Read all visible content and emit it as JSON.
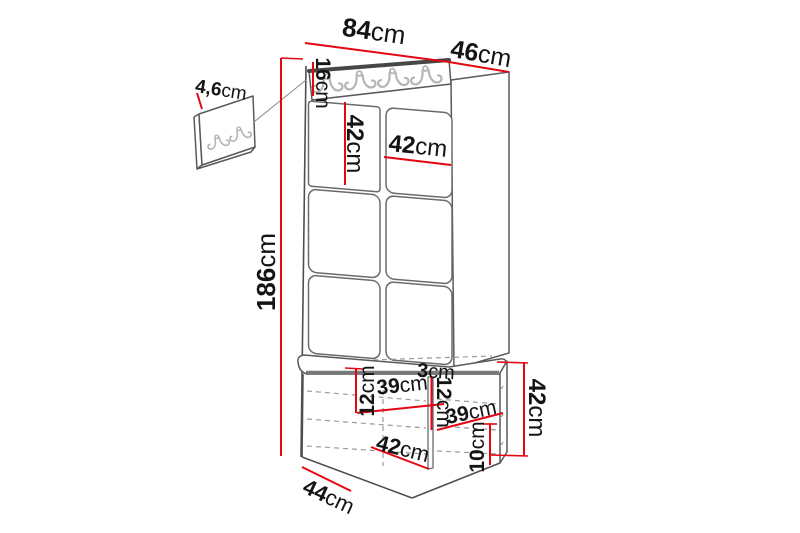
{
  "diagram": {
    "product": "hallway-unit-dimension-diagram",
    "unit": "cm",
    "dimensions": {
      "overall_width": {
        "value": "84",
        "unit": "cm"
      },
      "overall_depth": {
        "value": "46",
        "unit": "cm"
      },
      "hanger_thickness": {
        "value": "4,6",
        "unit": "cm"
      },
      "hook_rail_height": {
        "value": "16",
        "unit": "cm"
      },
      "panel_height": {
        "value": "42",
        "unit": "cm"
      },
      "panel_width": {
        "value": "42",
        "unit": "cm"
      },
      "overall_height": {
        "value": "186",
        "unit": "cm"
      },
      "seat_thickness": {
        "value": "12",
        "unit": "cm"
      },
      "left_shelf_width": {
        "value": "39",
        "unit": "cm"
      },
      "divider_thickness": {
        "value": "3",
        "unit": "cm"
      },
      "right_shelf_spacing": {
        "value": "12",
        "unit": "cm"
      },
      "right_shelf_width": {
        "value": "39",
        "unit": "cm"
      },
      "bench_inner_width": {
        "value": "42",
        "unit": "cm"
      },
      "bench_depth": {
        "value": "44",
        "unit": "cm"
      },
      "plinth_height": {
        "value": "10",
        "unit": "cm"
      },
      "bench_height": {
        "value": "42",
        "unit": "cm"
      }
    },
    "colors": {
      "dimension_line": "#e30613",
      "outline": "#4f4f4f",
      "dashed_line": "#9a9a9a",
      "hook": "#b5b5b5",
      "text": "#141414",
      "background": "#ffffff"
    }
  }
}
